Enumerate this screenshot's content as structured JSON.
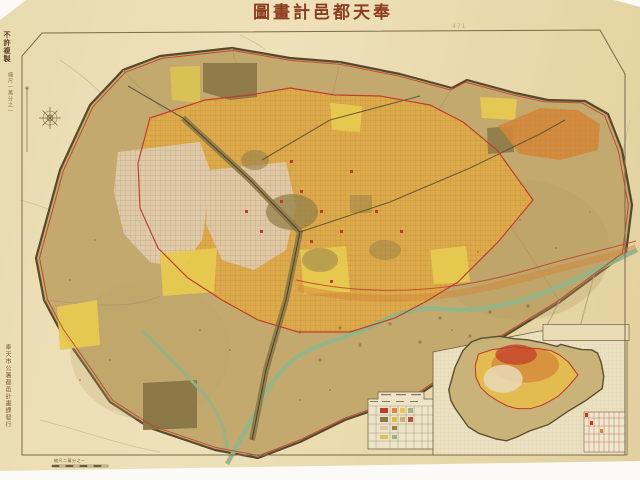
{
  "title": "奉天都邑計畫圖",
  "margin_notes": {
    "no_reproduction": "不許複製",
    "scale_note": "縮尺一萬分之一",
    "imprint": "奉天市公署都邑計畫課發行",
    "sheet_mark": "471",
    "scale_bar_label": "縮尺二萬分之一"
  },
  "inset": {
    "label": "奉天附近圖",
    "scale_label": "縮尺二十萬分之一"
  },
  "colors": {
    "paper": "#e9dbb0",
    "city_area_fill": "#c3a96e",
    "boundary_line": "#564a2c",
    "planning_red_line": "#c0392a",
    "urban_yellow": "#dcaa4b",
    "orange_zone": "#d4883a",
    "bright_yellow_patch": "#e7c94f",
    "pale_district": "#dfcaa8",
    "built_up_olive": "#8b7847",
    "river_green": "#92b489",
    "title_ink": "#8d3d22",
    "frame_line": "#7b6949",
    "inset_paper": "#ebe0c0"
  }
}
